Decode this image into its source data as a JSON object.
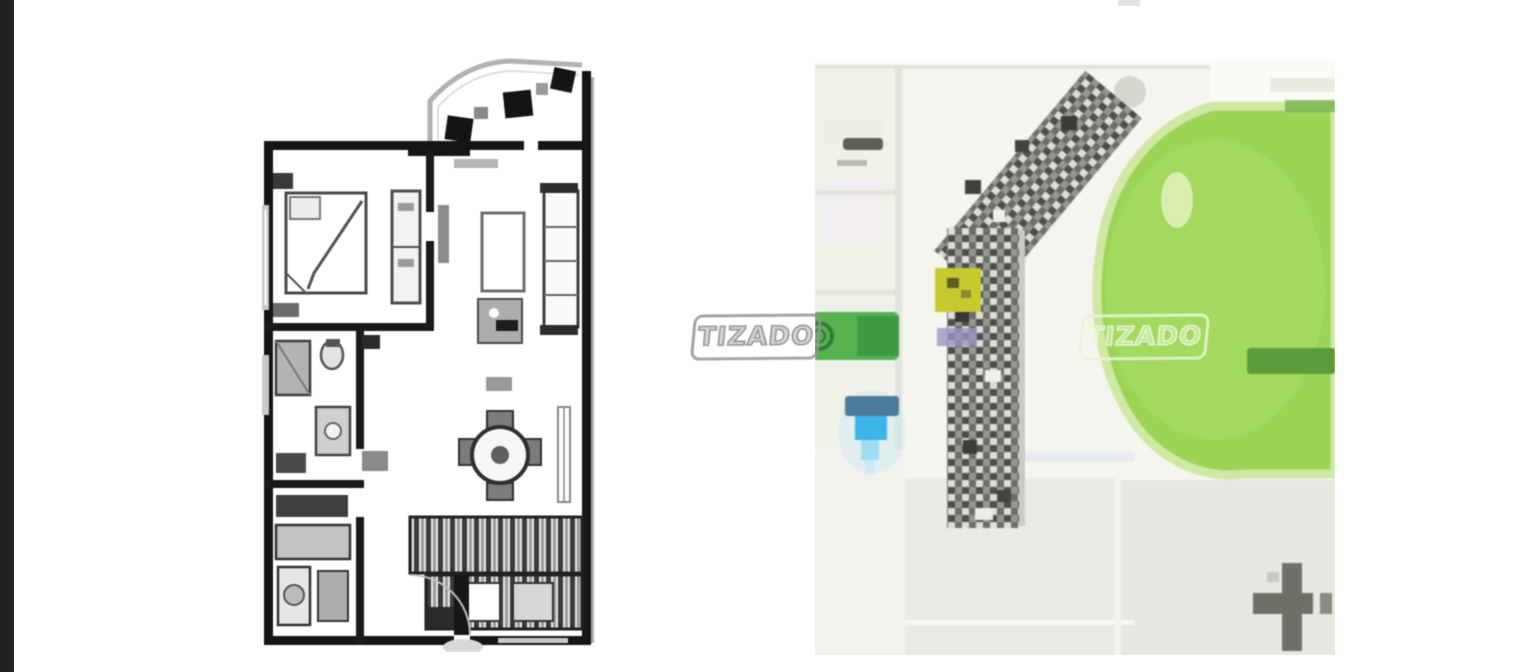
{
  "page": {
    "background": "#ffffff",
    "edge_bar_color": "#222222"
  },
  "watermarks": [
    {
      "text": "TIZADO"
    },
    {
      "text": "TIZADO"
    }
  ],
  "floor_plan": {
    "ink": "#151515",
    "wall_light": "#b2b2b2",
    "furniture_gray": "#555555"
  },
  "map": {
    "colors": {
      "background": "#f4f5ef",
      "park": "#9cd455",
      "park_rim": "#cfe9a4",
      "dark_green": "#5d9a3c",
      "building_base": "#b9bab6",
      "unit_highlight": "#c6ca2f",
      "accent_purple": "#9a93c6",
      "pin_dark": "#4d7b9a",
      "pin_bright": "#3eb5e6",
      "pin_light": "#9fdcf2",
      "green_label": "#57b14e",
      "cross": "#6f6f68",
      "road": "#e2e4da",
      "label_gray": "#5e5f57"
    }
  }
}
